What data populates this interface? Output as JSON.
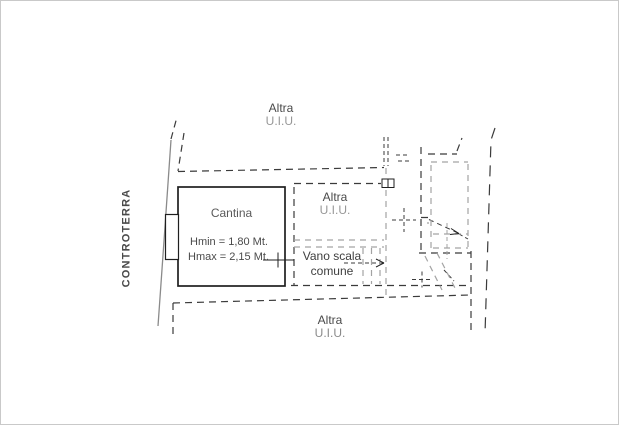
{
  "labels": {
    "controterra": "CONTROTERRA",
    "altra_top": {
      "line1": "Altra",
      "line2": "U.I.U."
    },
    "cantina": {
      "name": "Cantina",
      "hmin": "Hmin = 1,80 Mt.",
      "hmax": "Hmax = 2,15 Mt."
    },
    "altra_mid": {
      "line1": "Altra",
      "line2": "U.I.U."
    },
    "vano_scala": {
      "line1": "Vano scala",
      "line2": "comune"
    },
    "altra_bottom": {
      "line1": "Altra",
      "line2": "U.I.U."
    }
  },
  "colors": {
    "wall": "#1f1f1f",
    "outer_line": "#8a8a8a",
    "dash_dark": "#3b3b3b",
    "dash_gray": "#a3a3a3",
    "text_dark": "#4a4a4a",
    "text_gray": "#979797"
  }
}
